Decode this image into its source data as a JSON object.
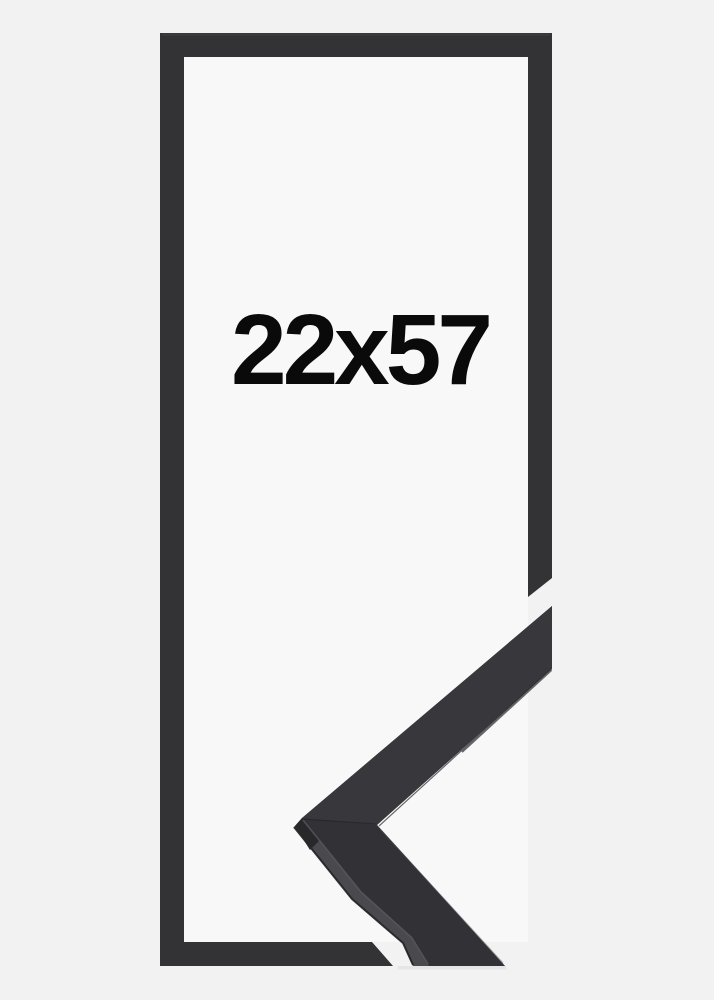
{
  "frame": {
    "size_label": "22x57"
  },
  "colors": {
    "background": "#f2f2f2",
    "interior": "#f8f8f8",
    "frame": "#333336",
    "frame_bevel": "#414144",
    "chevron_side": "#4a4a4e",
    "chevron_top_upper": "#38383c",
    "chevron_top_lower": "#323236",
    "chevron_edge_dark": "#202023",
    "chevron_groove": "#26262a",
    "chevron_highlight": "#56565b",
    "chevron_inner_highlight": "#4e4e53",
    "chevron_apex_shadow": "#28282b",
    "drop_shadow": "#d8d8d8",
    "text": "#0a0a0a"
  }
}
